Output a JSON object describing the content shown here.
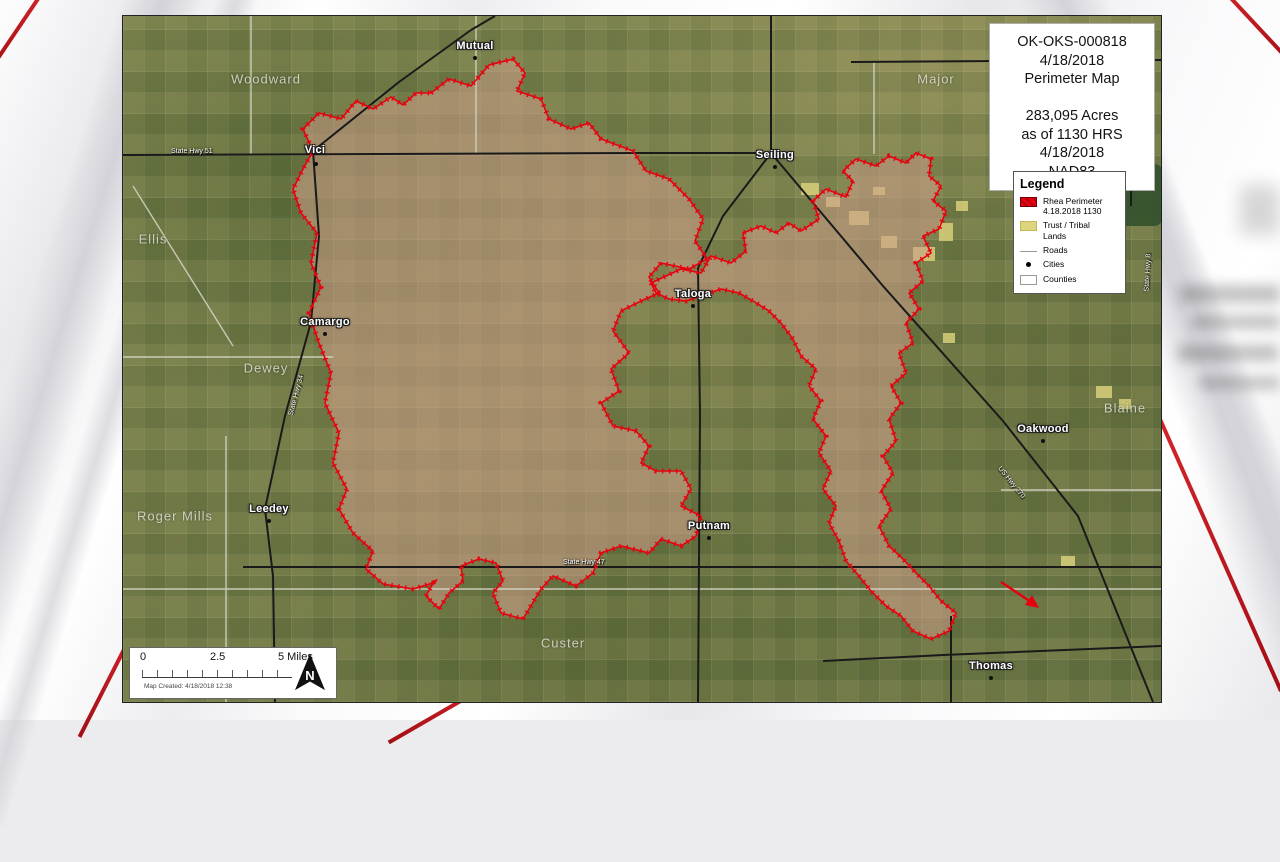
{
  "map": {
    "info_box": {
      "lines": [
        "OK-OKS-000818",
        "4/18/2018",
        "Perimeter Map",
        "",
        "283,095 Acres",
        "as of 1130 HRS",
        "4/18/2018",
        "NAD83"
      ]
    },
    "legend": {
      "title": "Legend",
      "items": [
        {
          "line1": "Rhea Perimeter",
          "line2": "4.18.2018 1130"
        },
        {
          "line1": "Trust / Tribal",
          "line2": "Lands"
        },
        {
          "line1": "Roads",
          "line2": ""
        },
        {
          "line1": "Cities",
          "line2": ""
        },
        {
          "line1": "Counties",
          "line2": ""
        }
      ]
    },
    "scale_bar": {
      "zero": "0",
      "mid": "2.5",
      "end": "5 Miles",
      "created": "Map Created: 4/18/2018 12:38",
      "north_letter": "N"
    },
    "cities": [
      {
        "name": "Mutual"
      },
      {
        "name": "Vici"
      },
      {
        "name": "Seiling"
      },
      {
        "name": "Taloga"
      },
      {
        "name": "Camargo"
      },
      {
        "name": "Leedey"
      },
      {
        "name": "Putnam"
      },
      {
        "name": "Oakwood"
      },
      {
        "name": "Thomas"
      }
    ],
    "counties": [
      {
        "name": "Woodward"
      },
      {
        "name": "Major"
      },
      {
        "name": "Ellis"
      },
      {
        "name": "Dewey"
      },
      {
        "name": "Roger Mills"
      },
      {
        "name": "Custer"
      },
      {
        "name": "Blaine"
      }
    ],
    "road_labels": [
      {
        "name": "State Hwy 51"
      },
      {
        "name": "State Hwy 34"
      },
      {
        "name": "State Hwy 47"
      },
      {
        "name": "US Hwy 270"
      },
      {
        "name": "State Hwy 8"
      }
    ],
    "colors": {
      "perimeter": "#e8000f",
      "burn_fill": "rgba(205,158,138,0.55)",
      "tribal_lands": "#ded47e",
      "highway": "#1a1a1a"
    }
  }
}
